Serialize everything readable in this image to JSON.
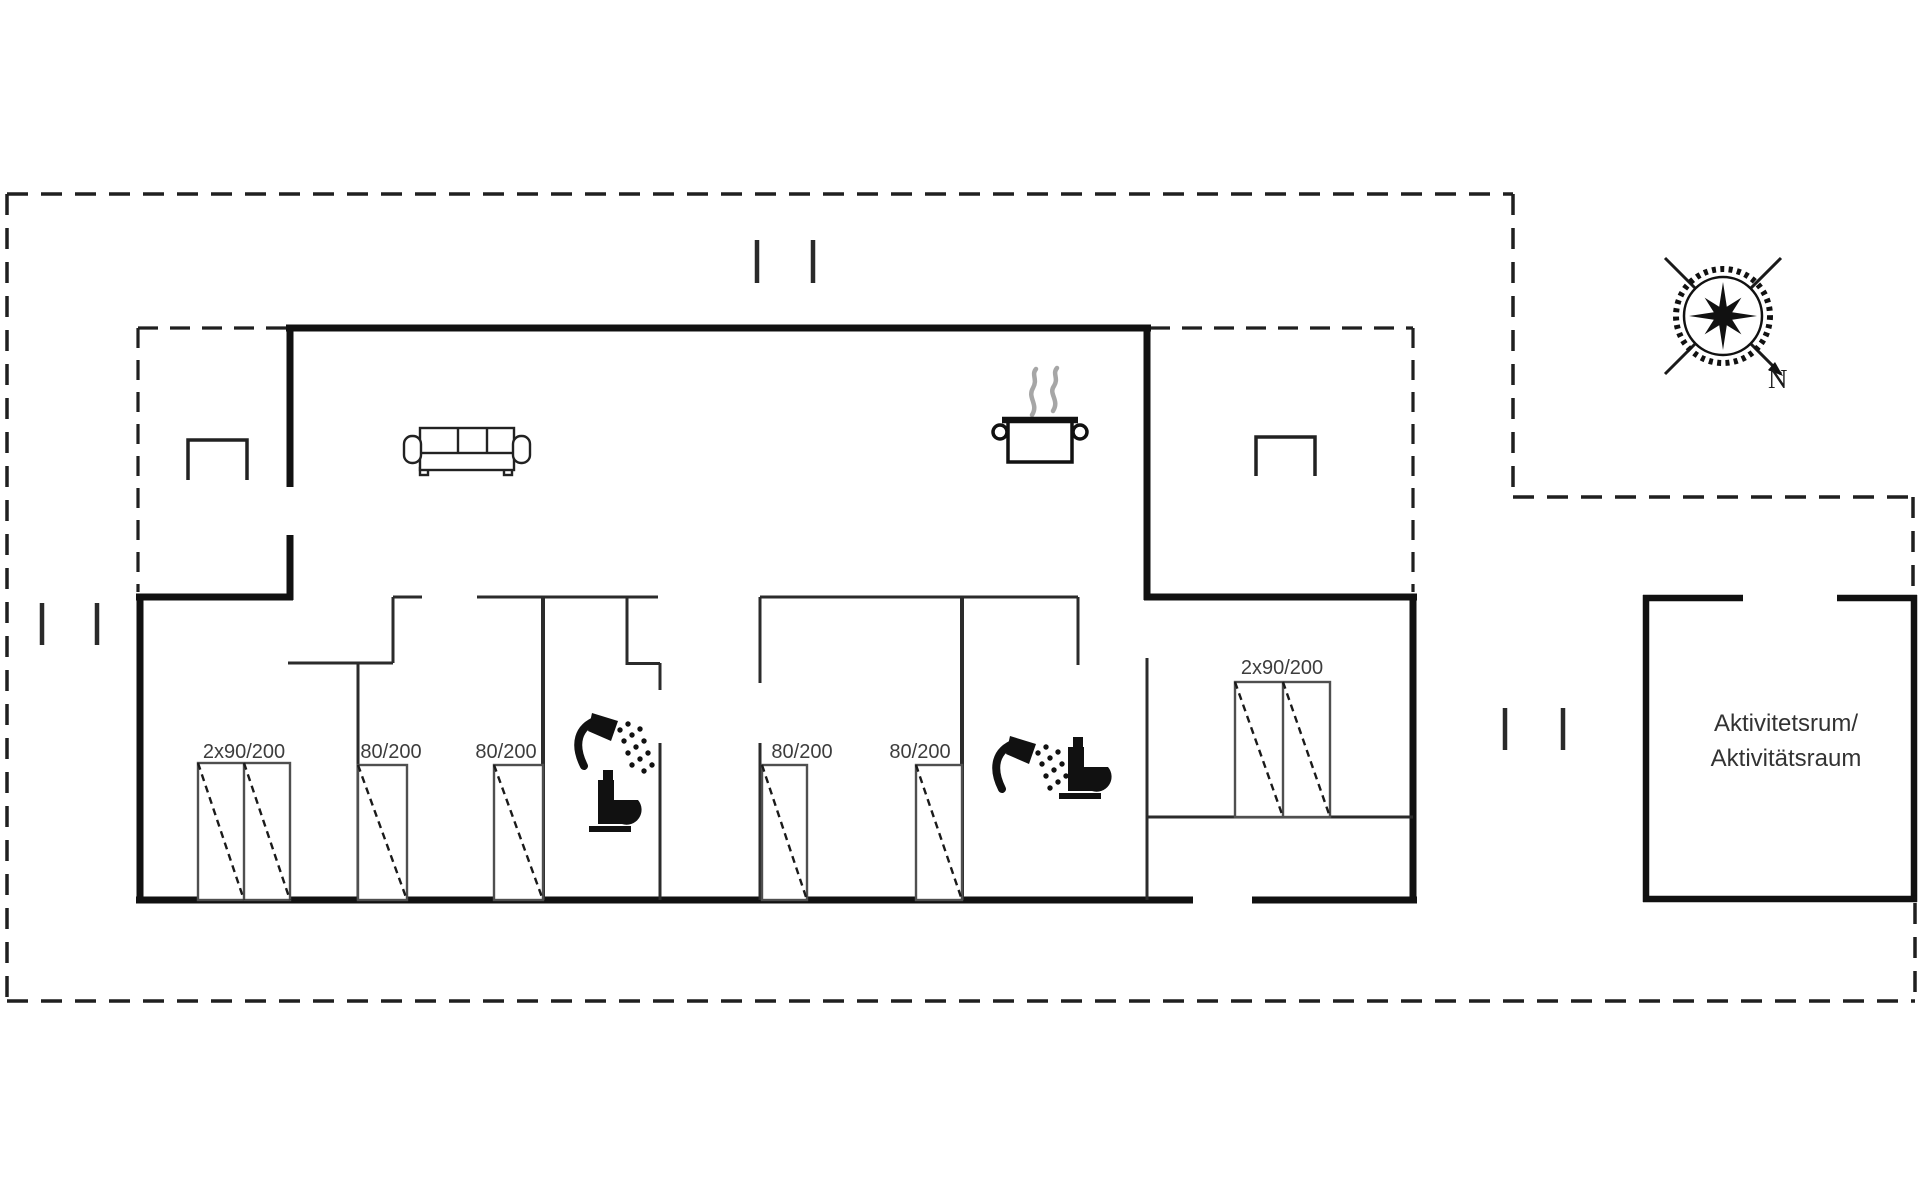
{
  "plan": {
    "beds": [
      {
        "id": "bed-double-west",
        "label": "2x90/200"
      },
      {
        "id": "bed-single-1",
        "label": "80/200"
      },
      {
        "id": "bed-single-2",
        "label": "80/200"
      },
      {
        "id": "bed-single-3",
        "label": "80/200"
      },
      {
        "id": "bed-single-4",
        "label": "80/200"
      },
      {
        "id": "bed-double-east",
        "label": "2x90/200"
      }
    ],
    "activity_room": {
      "line1": "Aktivitetsrum/",
      "line2": "Aktivitätsraum"
    },
    "compass": {
      "north_label": "N"
    },
    "icons": [
      {
        "name": "sofa-icon"
      },
      {
        "name": "cooking-pot-icon"
      },
      {
        "name": "shower-icon"
      },
      {
        "name": "toilet-icon"
      },
      {
        "name": "terrace-table-icon"
      },
      {
        "name": "compass-rose-icon"
      }
    ],
    "colors": {
      "exterior_wall": "#111111",
      "interior_wall": "#2b2b2b",
      "boundary_dashed": "#1f1f1f",
      "bed_outline": "#4f4f4f",
      "label_text": "#3d3d3d",
      "steam": "#a6a6a6",
      "background": "#ffffff"
    }
  }
}
